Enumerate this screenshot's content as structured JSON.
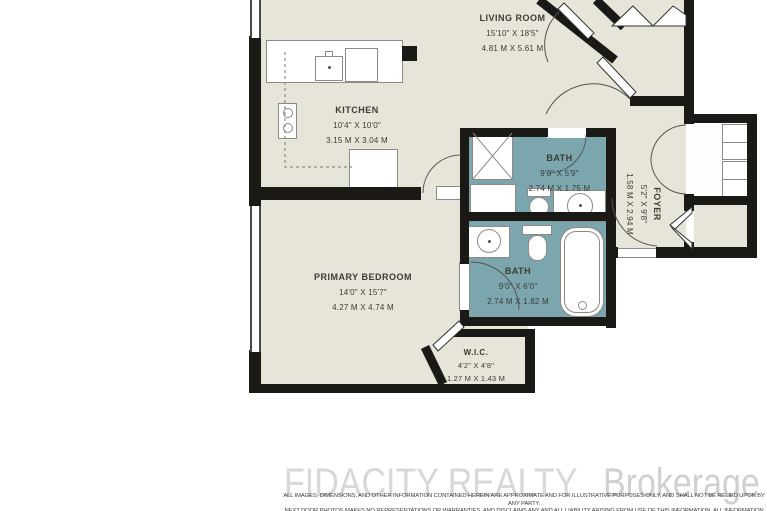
{
  "rooms": {
    "living": {
      "name": "LIVING ROOM",
      "imperial": "15'10\" X 18'5\"",
      "metric": "4.81 M X 5.61 M"
    },
    "kitchen": {
      "name": "KITCHEN",
      "imperial": "10'4\" X 10'0\"",
      "metric": "3.15 M X 3.04 M"
    },
    "bath_upper": {
      "name": "BATH",
      "imperial": "9'0\" X 5'9\"",
      "metric": "2.74 M X 1.75 M"
    },
    "bath_lower": {
      "name": "BATH",
      "imperial": "9'0\" X 6'0\"",
      "metric": "2.74 M X 1.82 M"
    },
    "foyer": {
      "name": "FOYER",
      "imperial": "5'2\" X 9'8\"",
      "metric": "1.58 M X 2.94 M"
    },
    "primary_bedroom": {
      "name": "PRIMARY BEDROOM",
      "imperial": "14'0\" X 15'7\"",
      "metric": "4.27 M X 4.74 M"
    },
    "wic": {
      "name": "W.I.C.",
      "imperial": "4'2\" X 4'8\"",
      "metric": "1.27 M X 1.43 M"
    }
  },
  "branding": {
    "brokerage_name": "FIDACITY REALTY",
    "brokerage_suffix": "Brokerage"
  },
  "disclaimer": {
    "line1": "ALL IMAGES, DIMENSIONS, AND OTHER INFORMATION CONTAINED HEREIN ARE APPROXIMATE AND FOR ILLUSTRATIVE PURPOSES ONLY, AND SHALL NOT BE RELIED UPON BY ANY PARTY.",
    "line2": "NEXT DOOR PHOTOS MAKES NO REPRESENTATIONS OR WARRANTIES, AND DISCLAIMS ANY AND ALL LIABILITY ARISING FROM USE OF THIS INFORMATION. ALL INFORMATION HEREIN"
  },
  "colors": {
    "floor": "#e7e4da",
    "bath_floor": "#7ba6ae",
    "wall": "#1a1915",
    "fixture_outline": "#8b8b84",
    "label_text": "#3c3b36",
    "watermark": "#d8d8d8",
    "disclaimer_text": "#3f3f3f"
  }
}
